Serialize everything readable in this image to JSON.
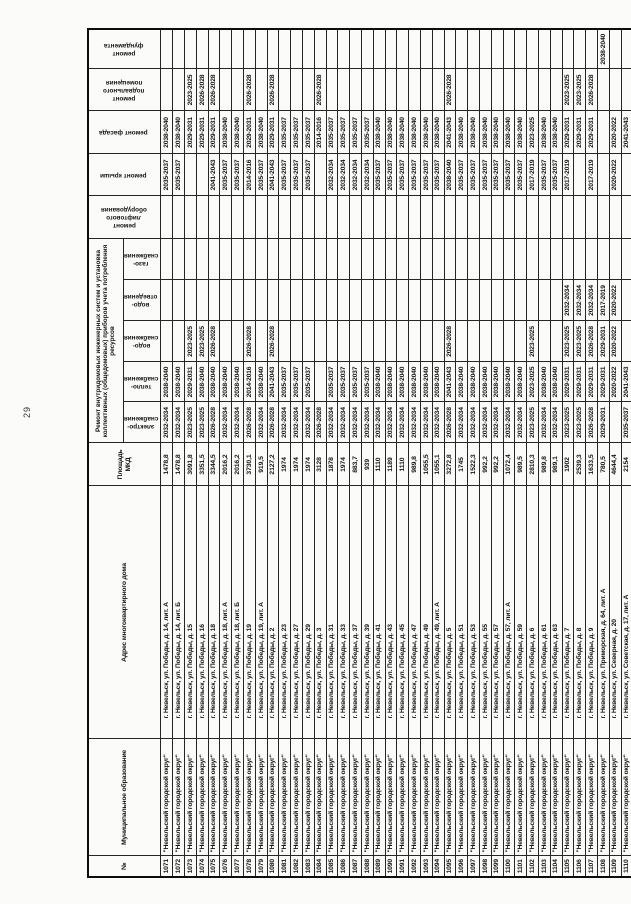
{
  "page": {
    "number": "29"
  },
  "table": {
    "headers": {
      "num": "№",
      "municipality": "Муниципальное образование",
      "address": "Адрес многоквартирного дома",
      "area": "Площадь\nМКД",
      "systems_group": "Ремонт внутридомовых инженерных систем и установка коллективных (общедомовых) приборов учета потребления ресурсов",
      "electro": "электро-\nснабжения",
      "heat": "тепло-\nснабжения",
      "water": "водо-\nснабжения",
      "sewer": "водо-\nотведения",
      "gas": "газо-\nснабжения",
      "elevator": "ремонт\nлифтового\nоборудования",
      "roof": "ремонт крыши",
      "facade": "ремонт фасада",
      "basement": "ремонт\nподвального\nпомещения",
      "foundation": "ремонт\nфундамента"
    },
    "municipality_value": "\"Невельский городской округ\"",
    "rows": [
      [
        "1071",
        "г. Невельск, ул. Победы, д. 14, лит. А",
        "1478,8",
        "2032-2034",
        "2038-2040",
        "",
        "",
        "",
        "",
        "2035-2037",
        "2038-2040",
        "",
        ""
      ],
      [
        "1072",
        "г. Невельск, ул. Победы, д. 14, лит. Б",
        "1478,8",
        "2032-2034",
        "2038-2040",
        "",
        "",
        "",
        "",
        "2035-2037",
        "2038-2040",
        "",
        ""
      ],
      [
        "1073",
        "г. Невельск, ул. Победы, д. 15",
        "3091,8",
        "2023-2025",
        "2029-2031",
        "2023-2025",
        "",
        "",
        "",
        "",
        "2029-2031",
        "2023-2025",
        ""
      ],
      [
        "1074",
        "г. Невельск, ул. Победы, д. 16",
        "3351,5",
        "2023-2025",
        "2038-2040",
        "2023-2025",
        "",
        "",
        "",
        "",
        "2029-2031",
        "2026-2028",
        ""
      ],
      [
        "1075",
        "г. Невельск, ул. Победы, д. 18",
        "3344,5",
        "2026-2028",
        "2038-2040",
        "2026-2028",
        "",
        "",
        "",
        "2041-2043",
        "2029-2031",
        "2026-2028",
        ""
      ],
      [
        "1076",
        "г. Невельск, ул. Победы, д. 18, лит. А",
        "2016,2",
        "2032-2034",
        "2038-2040",
        "",
        "",
        "",
        "",
        "2035-2037",
        "2038-2040",
        "",
        ""
      ],
      [
        "1077",
        "г. Невельск, ул. Победы, д. 18, лит. Б",
        "2016,2",
        "2032-2034",
        "2038-2040",
        "",
        "",
        "",
        "",
        "2035-2037",
        "2038-2040",
        "",
        ""
      ],
      [
        "1078",
        "г. Невельск, ул. Победы, д. 19",
        "3730,1",
        "2026-2028",
        "2014-2016",
        "2026-2028",
        "",
        "",
        "",
        "2014-2016",
        "2029-2031",
        "2026-2028",
        ""
      ],
      [
        "1079",
        "г. Невельск, ул. Победы, д. 19, лит. А",
        "919,5",
        "2032-2034",
        "2038-2040",
        "",
        "",
        "",
        "",
        "2035-2037",
        "2038-2040",
        "",
        ""
      ],
      [
        "1080",
        "г. Невельск, ул. Победы, д. 2",
        "2127,2",
        "2026-2028",
        "2041-2043",
        "2026-2028",
        "",
        "",
        "",
        "2041-2043",
        "2029-2031",
        "2026-2028",
        ""
      ],
      [
        "1081",
        "г. Невельск, ул. Победы, д. 23",
        "1974",
        "2032-2034",
        "2035-2037",
        "",
        "",
        "",
        "",
        "2035-2037",
        "2035-2037",
        "",
        ""
      ],
      [
        "1082",
        "г. Невельск, ул. Победы, д. 27",
        "1974",
        "2032-2034",
        "2035-2037",
        "",
        "",
        "",
        "",
        "2035-2037",
        "2035-2037",
        "",
        ""
      ],
      [
        "1083",
        "г. Невельск, ул. Победы, д. 29",
        "1974",
        "2032-2034",
        "2035-2037",
        "",
        "",
        "",
        "",
        "2035-2037",
        "2035-2037",
        "",
        ""
      ],
      [
        "1084",
        "г. Невельск, ул. Победы, д. 3",
        "3128",
        "2026-2028",
        "",
        "",
        "",
        "",
        "",
        "",
        "2014-2016",
        "2026-2028",
        ""
      ],
      [
        "1085",
        "г. Невельск, ул. Победы, д. 31",
        "1878",
        "2032-2034",
        "2035-2037",
        "",
        "",
        "",
        "",
        "2032-2034",
        "2035-2037",
        "",
        ""
      ],
      [
        "1086",
        "г. Невельск, ул. Победы, д. 33",
        "1974",
        "2032-2034",
        "2035-2037",
        "",
        "",
        "",
        "",
        "2032-2034",
        "2035-2037",
        "",
        ""
      ],
      [
        "1087",
        "г. Невельск, ул. Победы, д. 37",
        "883,7",
        "2032-2034",
        "2035-2037",
        "",
        "",
        "",
        "",
        "2032-2034",
        "2035-2037",
        "",
        ""
      ],
      [
        "1088",
        "г. Невельск, ул. Победы, д. 39",
        "939",
        "2032-2034",
        "2035-2037",
        "",
        "",
        "",
        "",
        "2032-2034",
        "2035-2037",
        "",
        ""
      ],
      [
        "1089",
        "г. Невельск, ул. Победы, д. 41",
        "1110",
        "2032-2034",
        "2038-2040",
        "",
        "",
        "",
        "",
        "2035-2037",
        "2038-2040",
        "",
        ""
      ],
      [
        "1090",
        "г. Невельск, ул. Победы, д. 43",
        "1189",
        "2032-2034",
        "2038-2040",
        "",
        "",
        "",
        "",
        "2035-2037",
        "2038-2040",
        "",
        ""
      ],
      [
        "1091",
        "г. Невельск, ул. Победы, д. 45",
        "1110",
        "2032-2034",
        "2038-2040",
        "",
        "",
        "",
        "",
        "2035-2037",
        "2038-2040",
        "",
        ""
      ],
      [
        "1092",
        "г. Невельск, ул. Победы, д. 47",
        "989,8",
        "2032-2034",
        "2038-2040",
        "",
        "",
        "",
        "",
        "2035-2037",
        "2038-2040",
        "",
        ""
      ],
      [
        "1093",
        "г. Невельск, ул. Победы, д. 49",
        "1055,5",
        "2032-2034",
        "2038-2040",
        "",
        "",
        "",
        "",
        "2035-2037",
        "2038-2040",
        "",
        ""
      ],
      [
        "1094",
        "г. Невельск, ул. Победы, д. 49, лит. А",
        "1055,1",
        "2032-2034",
        "2038-2040",
        "",
        "",
        "",
        "",
        "2035-2037",
        "2038-2040",
        "",
        ""
      ],
      [
        "1095",
        "г. Невельск, ул. Победы, д. 5",
        "3272,8",
        "2026-2028",
        "2041-2043",
        "2026-2028",
        "",
        "",
        "",
        "2038-2040",
        "2041-2043",
        "2026-2028",
        ""
      ],
      [
        "1096",
        "г. Невельск, ул. Победы, д. 51",
        "1745",
        "2032-2034",
        "2038-2040",
        "",
        "",
        "",
        "",
        "2035-2037",
        "2038-2040",
        "",
        ""
      ],
      [
        "1097",
        "г. Невельск, ул. Победы, д. 53",
        "1522,3",
        "2032-2034",
        "2038-2040",
        "",
        "",
        "",
        "",
        "2035-2037",
        "2038-2040",
        "",
        ""
      ],
      [
        "1098",
        "г. Невельск, ул. Победы, д. 55",
        "992,2",
        "2032-2034",
        "2038-2040",
        "",
        "",
        "",
        "",
        "2035-2037",
        "2038-2040",
        "",
        ""
      ],
      [
        "1099",
        "г. Невельск, ул. Победы, д. 57",
        "992,2",
        "2032-2034",
        "2038-2040",
        "",
        "",
        "",
        "",
        "2035-2037",
        "2038-2040",
        "",
        ""
      ],
      [
        "1100",
        "г. Невельск, ул. Победы, д. 57, лит. А",
        "1072,4",
        "2032-2034",
        "2038-2040",
        "",
        "",
        "",
        "",
        "2035-2037",
        "2038-2040",
        "",
        ""
      ],
      [
        "1101",
        "г. Невельск, ул. Победы, д. 59",
        "989,5",
        "2032-2034",
        "2038-2040",
        "",
        "",
        "",
        "",
        "2035-2037",
        "2038-2040",
        "",
        ""
      ],
      [
        "1102",
        "г. Невельск, ул. Победы, д. 6",
        "2810,3",
        "2023-2025",
        "2023-2025",
        "2023-2025",
        "",
        "",
        "",
        "2017-2019",
        "2023-2025",
        "",
        ""
      ],
      [
        "1103",
        "г. Невельск, ул. Победы, д. 61",
        "989,8",
        "2032-2034",
        "2038-2040",
        "",
        "",
        "",
        "",
        "2035-2037",
        "2038-2040",
        "",
        ""
      ],
      [
        "1104",
        "г. Невельск, ул. Победы, д. 63",
        "989,1",
        "2032-2034",
        "2038-2040",
        "",
        "",
        "",
        "",
        "2035-2037",
        "2038-2040",
        "",
        ""
      ],
      [
        "1105",
        "г. Невельск, ул. Победы, д. 7",
        "1902",
        "2023-2025",
        "2029-2031",
        "2023-2025",
        "2032-2034",
        "",
        "",
        "2017-2019",
        "2029-2031",
        "2023-2025",
        ""
      ],
      [
        "1106",
        "г. Невельск, ул. Победы, д. 8",
        "2539,3",
        "2023-2025",
        "2029-2031",
        "2023-2025",
        "2032-2034",
        "",
        "",
        "",
        "2029-2031",
        "2023-2025",
        ""
      ],
      [
        "1107",
        "г. Невельск, ул. Победы, д. 9",
        "1633,5",
        "2026-2028",
        "2029-2031",
        "2026-2028",
        "2032-2034",
        "",
        "",
        "2017-2019",
        "2029-2031",
        "2026-2028",
        ""
      ],
      [
        "1108",
        "г. Невельск, ул. Приморская, д. 64, лит. А",
        "780,5",
        "2029-2031",
        "2029-2031",
        "2029-2031",
        "2017-2019",
        "",
        "",
        "",
        "",
        "",
        "2038-2040"
      ],
      [
        "1109",
        "г. Невельск, ул. Северная, д. 20",
        "4644,4",
        "",
        "2020-2022",
        "2020-2022",
        "2020-2022",
        "",
        "",
        "2020-2022",
        "2020-2022",
        "",
        ""
      ],
      [
        "1110",
        "г. Невельск, ул. Советская, д. 17, лит. А",
        "2154",
        "2035-2037",
        "2041-2043",
        "",
        "",
        "",
        "",
        "",
        "2041-2043",
        "",
        ""
      ]
    ]
  }
}
